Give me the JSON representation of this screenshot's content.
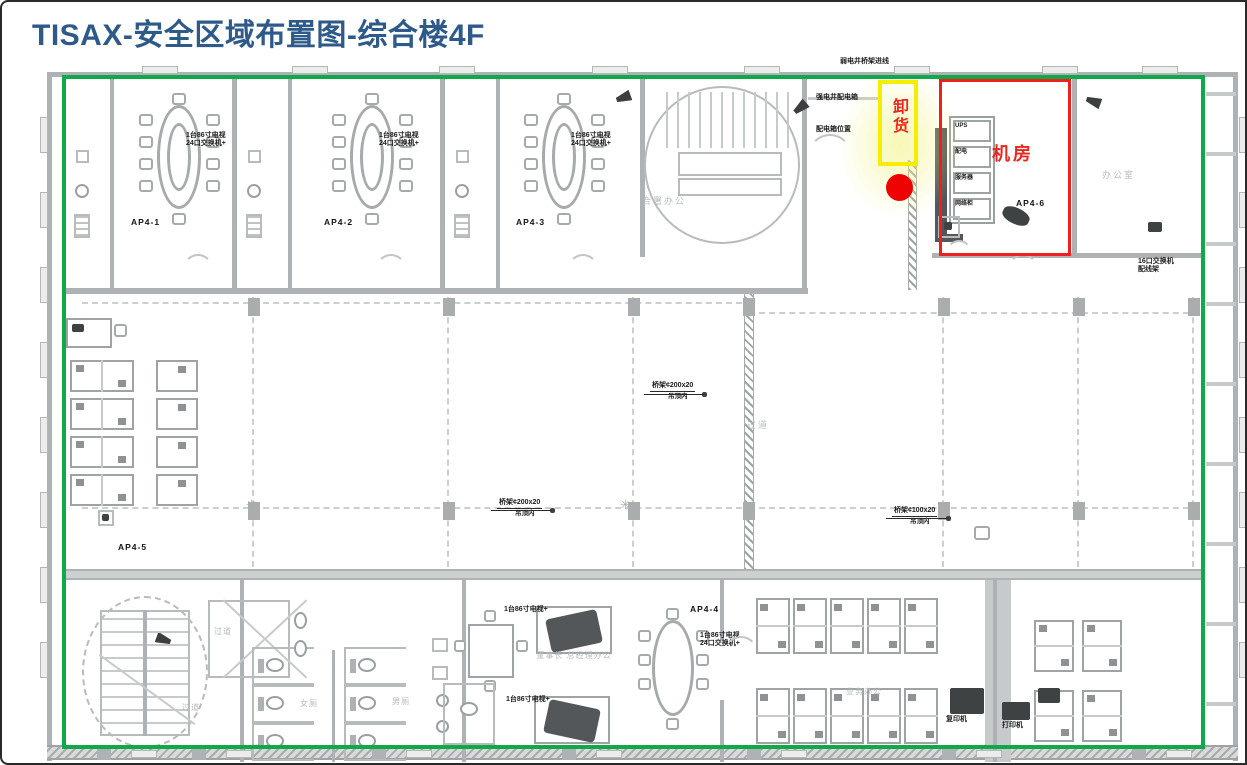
{
  "title": "TISAX-安全区域布置图-综合楼4F",
  "colors": {
    "title_blue": "#2d5a88",
    "security_green": "#10a94a",
    "highlight_red": "#ef1f1f",
    "highlight_yellow": "#f6ee00",
    "marker_red": "#ee0202",
    "label_red": "#e8281e"
  },
  "overlays": {
    "server_room": "机房",
    "unloading": "卸货"
  },
  "rooms": {
    "corridor_center": "过道",
    "corridor_stair": "过道",
    "corridor_stair2": "过道",
    "joint_office": "合署办公",
    "office_right": "办公室",
    "exec_office": "董事长 总经理办公",
    "open_office": "业务办公",
    "toilet_female": "女厕",
    "toilet_male": "男厕"
  },
  "ap_labels": [
    "AP4-1",
    "AP4-2",
    "AP4-3",
    "AP4-4",
    "AP4-5",
    "AP4-6"
  ],
  "annotations": {
    "tv_note_line1": "1台86寸电视",
    "tv_note_line2": "24口交换机+",
    "leaders": [
      {
        "text": "桥架¢200x20",
        "sub": "吊顶内"
      },
      {
        "text": "桥架¢200x20",
        "sub": "吊顶内"
      },
      {
        "text": "桥架¢100x20",
        "sub": "吊顶内"
      }
    ],
    "micro_top": [
      "弱电井桥架进线",
      "强电井配电箱",
      "配电箱位置"
    ],
    "rack_items": [
      "UPS",
      "配电",
      "服务器",
      "网络柜"
    ],
    "equipment": [
      "复印机",
      "打印机"
    ],
    "right_note": "16口交换机\n配线架",
    "exec_note": "1台86寸电视+"
  }
}
